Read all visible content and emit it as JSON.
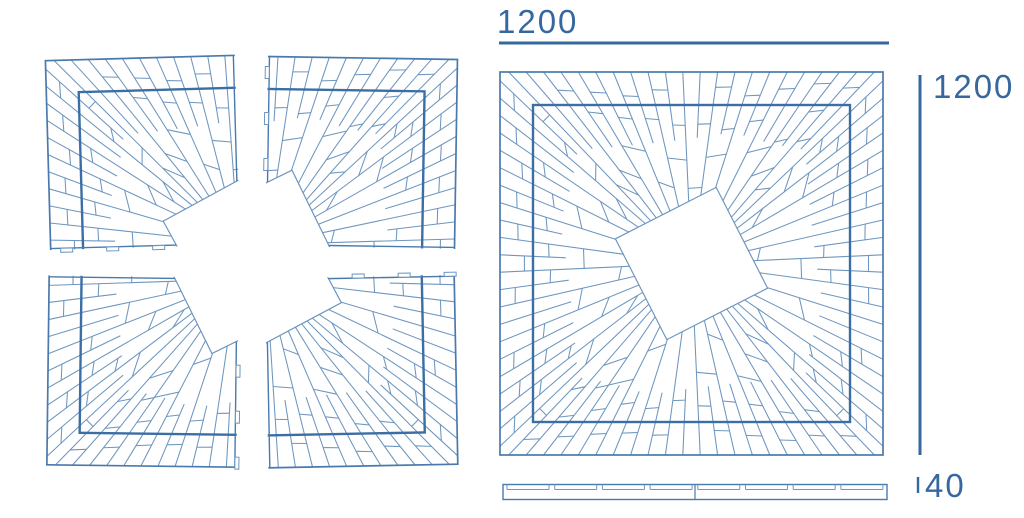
{
  "drawing": {
    "type": "tree-grate technical drawing",
    "dimensions": {
      "width_label": "1200",
      "height_label": "1200",
      "thickness_label": "40"
    },
    "colors": {
      "line": "#6e96bf",
      "outline": "#4a7aac",
      "inner_frame": "#3a6ea5",
      "dimension": "#36689e",
      "background": "#ffffff"
    }
  }
}
